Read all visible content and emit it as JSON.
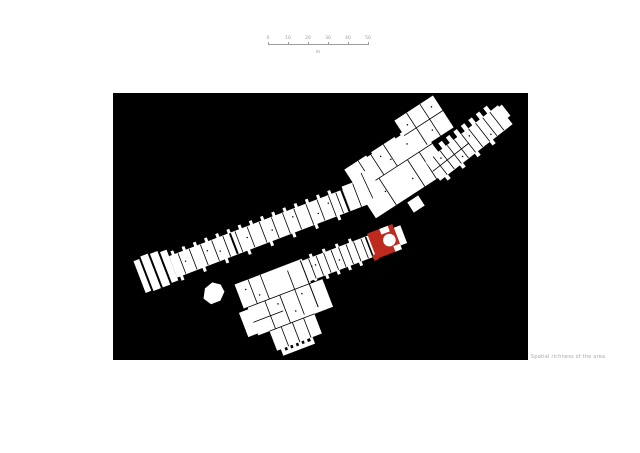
{
  "figure": {
    "caption": "Spatial richness of the area"
  },
  "scalebar": {
    "tick_labels": [
      "0",
      "10",
      "20",
      "30",
      "40",
      "50"
    ],
    "unit": "m"
  },
  "colors": {
    "page_background": "#ffffff",
    "canvas_background": "#000000",
    "plan_fill": "#ffffff",
    "highlight_room": "#bf2a1e",
    "scalebar_text": "#9b9b9b",
    "caption_text": "#a8a8a8"
  },
  "plan": {
    "type": "architectural-floor-plan",
    "elements": [
      "main-wing",
      "upper-block",
      "top-block",
      "north-branch",
      "lower-wing",
      "lower-cluster",
      "detached-building",
      "highlighted-room"
    ],
    "highlighted_element": "highlighted-room"
  }
}
